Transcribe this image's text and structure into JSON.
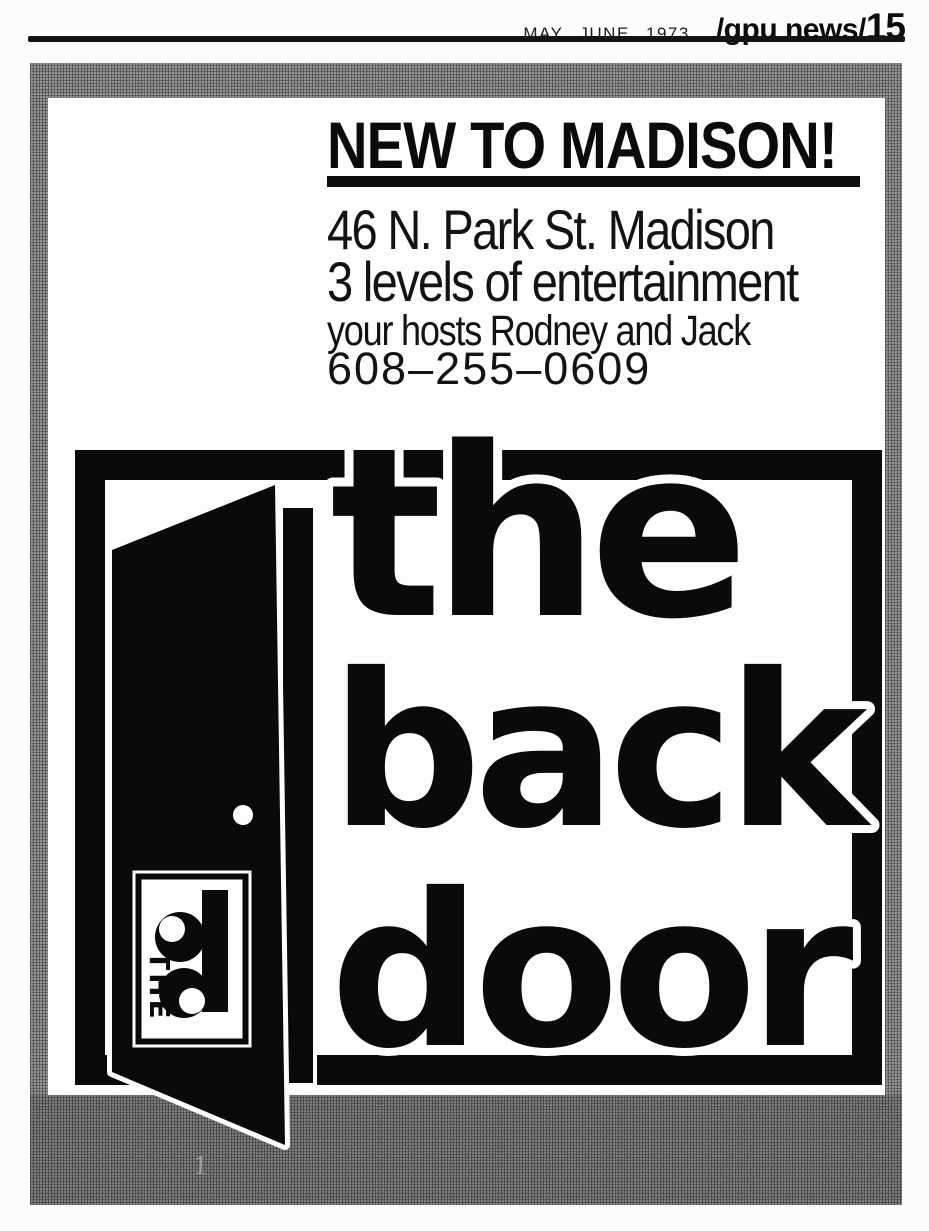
{
  "header": {
    "issue_date": "MAY JUNE 1973",
    "masthead": "/gpu news/",
    "page_number": "15"
  },
  "ad": {
    "headline": "NEW TO MADISON!",
    "lines": {
      "address": "46 N. Park St. Madison",
      "tagline": "3 levels of entertainment",
      "hosts": "your hosts Rodney and Jack",
      "phone": "608–255–0609"
    },
    "logo": {
      "word1": "the",
      "word2": "back",
      "word3": "door",
      "badge_vertical_text": "THE",
      "badge_monogram": "bd"
    },
    "colors": {
      "ink": "#0d0d0d",
      "halftone_border": "#868686",
      "halftone_bottom": "#6d6d6d"
    }
  },
  "artifacts": {
    "scan_mark": "1"
  }
}
